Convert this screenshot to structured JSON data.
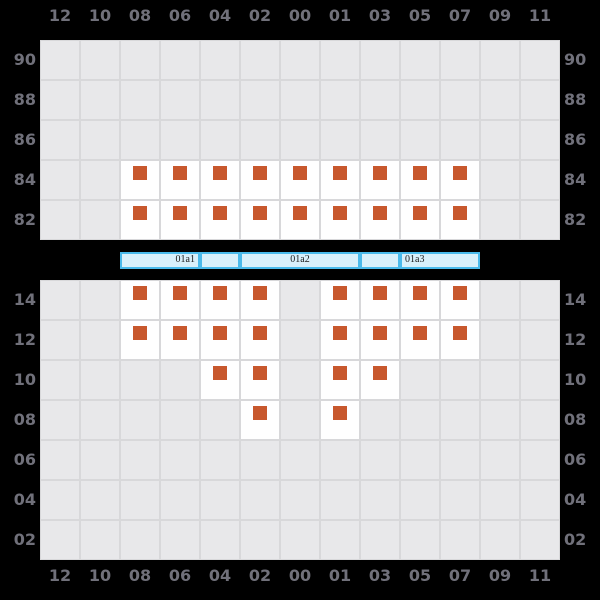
{
  "chart_data": {
    "type": "heatmap",
    "title": "",
    "description": "Two slot-grid panels; orange markers show occupied slots; cyan segment band between panels",
    "column_labels": [
      "12",
      "10",
      "08",
      "06",
      "04",
      "02",
      "00",
      "01",
      "03",
      "05",
      "07",
      "09",
      "11"
    ],
    "top_panel": {
      "row_labels": [
        "90",
        "88",
        "86",
        "84",
        "82"
      ],
      "occupied": {
        "84": [
          "08",
          "06",
          "04",
          "02",
          "00",
          "01",
          "03",
          "05",
          "07"
        ],
        "82": [
          "08",
          "06",
          "04",
          "02",
          "00",
          "01",
          "03",
          "05",
          "07"
        ]
      }
    },
    "bottom_panel": {
      "row_labels": [
        "14",
        "12",
        "10",
        "08",
        "06",
        "04",
        "02"
      ],
      "occupied": {
        "14": [
          "08",
          "06",
          "04",
          "02",
          "01",
          "03",
          "05",
          "07"
        ],
        "12": [
          "08",
          "06",
          "04",
          "02",
          "01",
          "03",
          "05",
          "07"
        ],
        "10": [
          "04",
          "02",
          "01",
          "03"
        ],
        "08": [
          "02",
          "01"
        ]
      }
    },
    "band": {
      "segments": [
        {
          "label": "01a1",
          "width": 80,
          "align": "right"
        },
        {
          "label": "",
          "width": 40,
          "align": "center"
        },
        {
          "label": "01a2",
          "width": 120,
          "align": "center"
        },
        {
          "label": "",
          "width": 40,
          "align": "center"
        },
        {
          "label": "01a3",
          "width": 80,
          "align": "left"
        }
      ]
    },
    "colors": {
      "background": "#000000",
      "empty_cell": "#e8e8ea",
      "gridline": "#d8d8da",
      "occupied_cell": "#ffffff",
      "marker": "#c8582d",
      "axis_label": "#70707a",
      "band_fill": "#d8f0fb",
      "band_border": "#4abaeb",
      "band_label": "#1a1a1a"
    },
    "layout": {
      "cell_size": 40,
      "grid_left": 40,
      "top_grid_y": 40,
      "bottom_grid_y": 280,
      "band_x": 120,
      "band_y": 252
    }
  }
}
